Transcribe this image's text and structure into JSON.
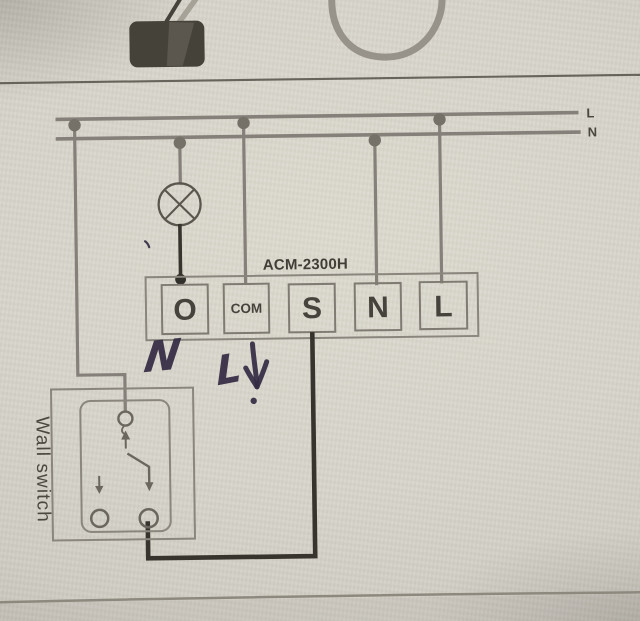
{
  "figure": {
    "bus": {
      "live_label": "L",
      "neutral_label": "N"
    },
    "module": {
      "name": "ACM-2300H",
      "terminals": [
        {
          "label": "O"
        },
        {
          "label": "COM"
        },
        {
          "label": "S"
        },
        {
          "label": "N"
        },
        {
          "label": "L"
        }
      ]
    },
    "wall_switch": {
      "label": "Wall switch"
    },
    "handwriting": {
      "neutral_mark": "N",
      "live_mark": "L",
      "arrow": "↓"
    },
    "icons": {
      "lamp": "circle-with-diagonal-cross",
      "cable_loop": "u-shaped-cord",
      "device_knob": "dark-rounded-block",
      "junction": "filled-dot",
      "switch_contacts": "open-circles",
      "direction_arrows": "small-down-and-up-arrows"
    },
    "colors": {
      "paper": "#d7d4cb",
      "print_gray": "#85817a",
      "print_dark": "#55524a",
      "wire_dark": "#36342d",
      "label_text": "#45433b",
      "marker_ink": "#352c44"
    }
  }
}
